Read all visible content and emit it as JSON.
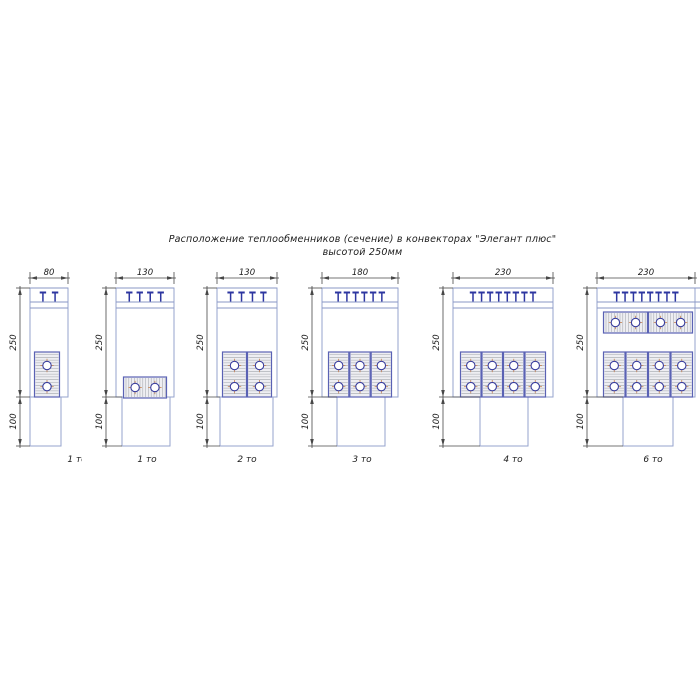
{
  "title": {
    "line1": "Расположение теплообменников (сечение) в конвекторах \"Элегант плюс\"",
    "line2": "высотой 250мм"
  },
  "dim_labels": {
    "upper": "250",
    "lower": "100"
  },
  "colors": {
    "outline": "#95a3ce",
    "grille_line": "#8a97c6",
    "grille_mark": "#2d36a0",
    "block_border": "#5a62b4",
    "block_fill": "#eeeef2",
    "hatch": "#a2a6ad",
    "tube_ring": "#3a3e9e",
    "tube_fill": "#ffffff",
    "crosshair": "#c8824e",
    "dim": "#474747",
    "text": "#1c1c1c"
  },
  "convectors": [
    {
      "width_label": "80",
      "unit_label": "1 то",
      "marks": 2,
      "geom": {
        "x": 30,
        "w": 38,
        "duct_x": 0,
        "duct_w": 31,
        "label_dx": 28,
        "overflow": 0
      },
      "banks": [
        {
          "orient": "v",
          "count": 1,
          "x": 4,
          "y": 64,
          "w": 26,
          "h": 45
        }
      ]
    },
    {
      "width_label": "130",
      "unit_label": "1 то",
      "marks": 4,
      "geom": {
        "x": 116,
        "w": 58,
        "duct_x": 6,
        "duct_w": 48,
        "label_dx": 2,
        "overflow": 0
      },
      "banks": [
        {
          "orient": "h",
          "count": 1,
          "x": 7,
          "y": 89,
          "w": 44,
          "h": 21
        }
      ]
    },
    {
      "width_label": "130",
      "unit_label": "2 то",
      "marks": 4,
      "geom": {
        "x": 217,
        "w": 60,
        "duct_x": 3,
        "duct_w": 53,
        "label_dx": 0,
        "overflow": 0
      },
      "banks": [
        {
          "orient": "v",
          "count": 2,
          "x": 5,
          "y": 64,
          "w": 50,
          "h": 45
        }
      ]
    },
    {
      "width_label": "180",
      "unit_label": "3 то",
      "marks": 6,
      "geom": {
        "x": 322,
        "w": 76,
        "duct_x": 15,
        "duct_w": 48,
        "label_dx": 2,
        "overflow": 0
      },
      "banks": [
        {
          "orient": "v",
          "count": 3,
          "x": 6,
          "y": 64,
          "w": 64,
          "h": 45
        }
      ]
    },
    {
      "width_label": "230",
      "unit_label": "4 то",
      "marks": 8,
      "geom": {
        "x": 453,
        "w": 100,
        "duct_x": 27,
        "duct_w": 48,
        "label_dx": 10,
        "overflow": 0
      },
      "banks": [
        {
          "orient": "v",
          "count": 4,
          "x": 7,
          "y": 64,
          "w": 86,
          "h": 45
        }
      ]
    },
    {
      "width_label": "230",
      "unit_label": "6 то",
      "marks": 8,
      "geom": {
        "x": 597,
        "w": 98,
        "duct_x": 26,
        "duct_w": 50,
        "label_dx": 7,
        "overflow": 6
      },
      "banks": [
        {
          "orient": "h",
          "count": 2,
          "x": 6,
          "y": 24,
          "w": 90,
          "h": 21
        },
        {
          "orient": "v",
          "count": 4,
          "x": 6,
          "y": 64,
          "w": 90,
          "h": 45
        }
      ]
    }
  ]
}
